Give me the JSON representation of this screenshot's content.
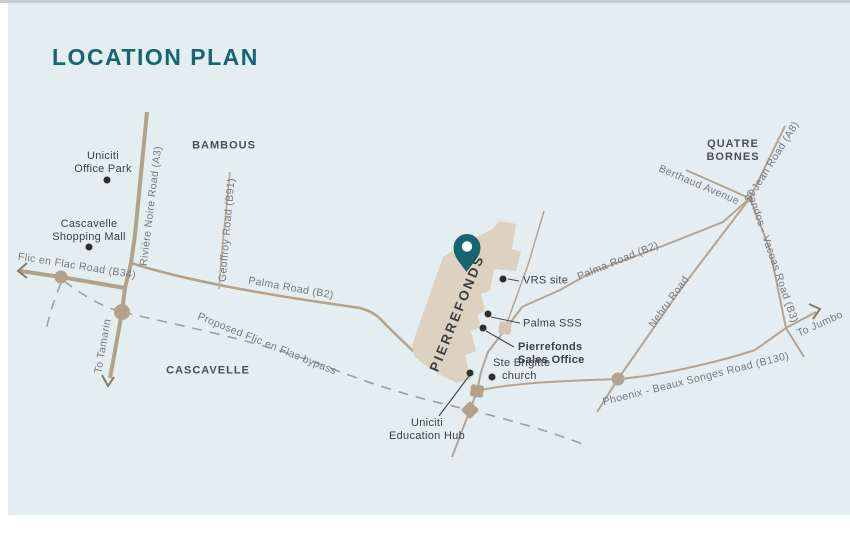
{
  "title": "LOCATION PLAN",
  "areas": {
    "bambous": "BAMBOUS",
    "quatre_bornes_line1": "QUATRE",
    "quatre_bornes_line2": "BORNES",
    "cascavelle": "CASCAVELLE"
  },
  "site": {
    "name": "PIERREFONDS"
  },
  "roads": {
    "riviere_noire": "Rivière Noire Road (A3)",
    "geoffroy": "Geoffroy Road (B91)",
    "flic_en_flac": "Flic en Flac Road (B34)",
    "palma_west": "Palma Road (B2)",
    "palma_east": "Palma Road (B2)",
    "bypass": "Proposed Flic en Flac bypass",
    "nehru": "Nehru Road",
    "berthaud": "Berthaud Avenue",
    "st_jean": "St Jean Road (A8)",
    "candos": "Candos - Vacoas Road (B3)",
    "phoenix": "Phoenix - Beaux Songes Road (B130)"
  },
  "directions": {
    "tamarin": "To Tamarin",
    "jumbo": "To Jumbo"
  },
  "pois": {
    "office_park_line1": "Uniciti",
    "office_park_line2": "Office Park",
    "shopping_mall_line1": "Cascavelle",
    "shopping_mall_line2": "Shopping Mall",
    "vrs": "VRS site",
    "palma_sss": "Palma SSS",
    "sales_office_line1": "Pierrefonds",
    "sales_office_line2": "Sales Office",
    "ste_brigitte_line1": "Ste Brigitte",
    "ste_brigitte_line2": "church",
    "education_hub_line1": "Uniciti",
    "education_hub_line2": "Education Hub"
  },
  "colors": {
    "accent_teal": "#156672",
    "road_tan": "#b3a289",
    "road_tan_light": "#b9ab94",
    "site_fill": "#ddd2bf",
    "panel_bg": "#e4eef0",
    "bypass_grey": "#97a2a6",
    "dot_black": "#2e2e2e"
  }
}
